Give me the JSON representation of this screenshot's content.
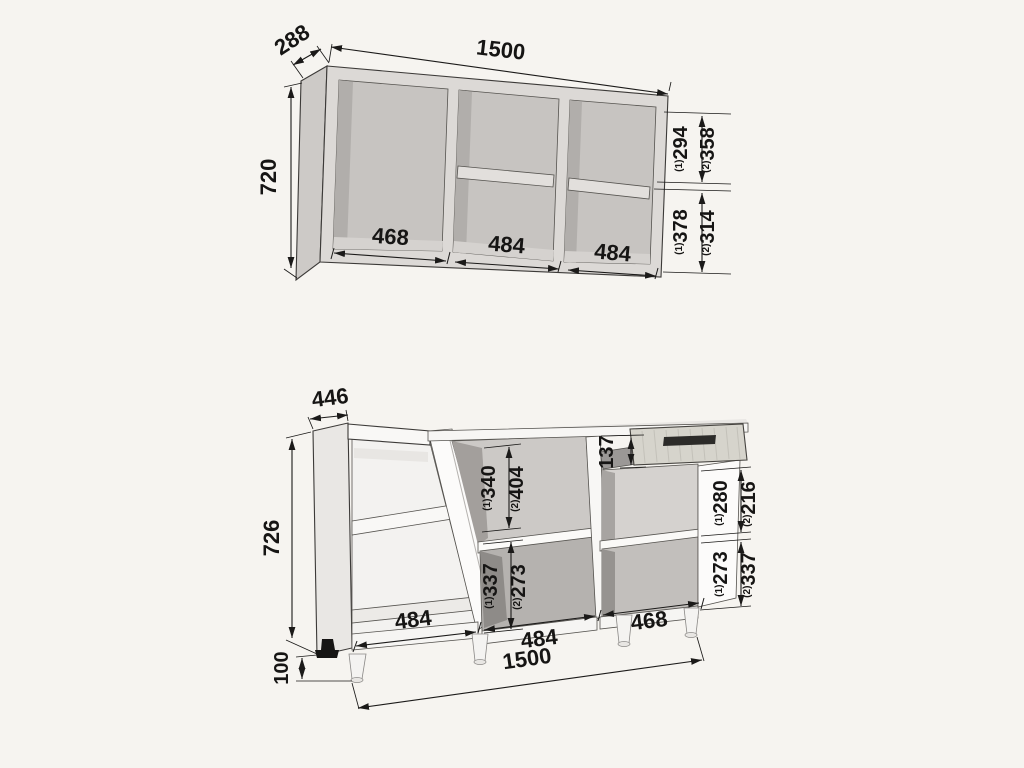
{
  "title": "kitchen-cabinet-dimension-diagram",
  "colors": {
    "background": "#f6f4f0",
    "ink": "#1b1a19",
    "upper_frame": "#dcd9d6",
    "upper_interior": "#c7c4c1",
    "upper_shadow": "#b1aeab",
    "base_panel": "#f7f6f4",
    "base_interior_dark": "#9b9896",
    "drawer_wood": "#d6d4cc",
    "handle": "#2c2b29",
    "foot": "#161514"
  },
  "upper": {
    "name": "wall cabinet",
    "width": "1500",
    "depth": "288",
    "height": "720",
    "widths": [
      "468",
      "484",
      "484"
    ],
    "split_top": {
      "s1": "(1)",
      "v1": "294",
      "s2": "(2)",
      "v2": "358"
    },
    "split_bottom": {
      "s1": "(1)",
      "v1": "378",
      "s2": "(2)",
      "v2": "314"
    }
  },
  "base": {
    "name": "base cabinet",
    "width": "1500",
    "depth": "446",
    "height": "726",
    "leg_height": "100",
    "drawer_height": "137",
    "widths": [
      "484",
      "484",
      "468"
    ],
    "mid_top": {
      "s1": "(1)",
      "v1": "340",
      "s2": "(2)",
      "v2": "404"
    },
    "mid_bottom": {
      "s1": "(1)",
      "v1": "337",
      "s2": "(2)",
      "v2": "273"
    },
    "right_top": {
      "s1": "(1)",
      "v1": "280",
      "s2": "(2)",
      "v2": "216"
    },
    "right_bottom": {
      "s1": "(1)",
      "v1": "273",
      "s2": "(2)",
      "v2": "337"
    }
  }
}
